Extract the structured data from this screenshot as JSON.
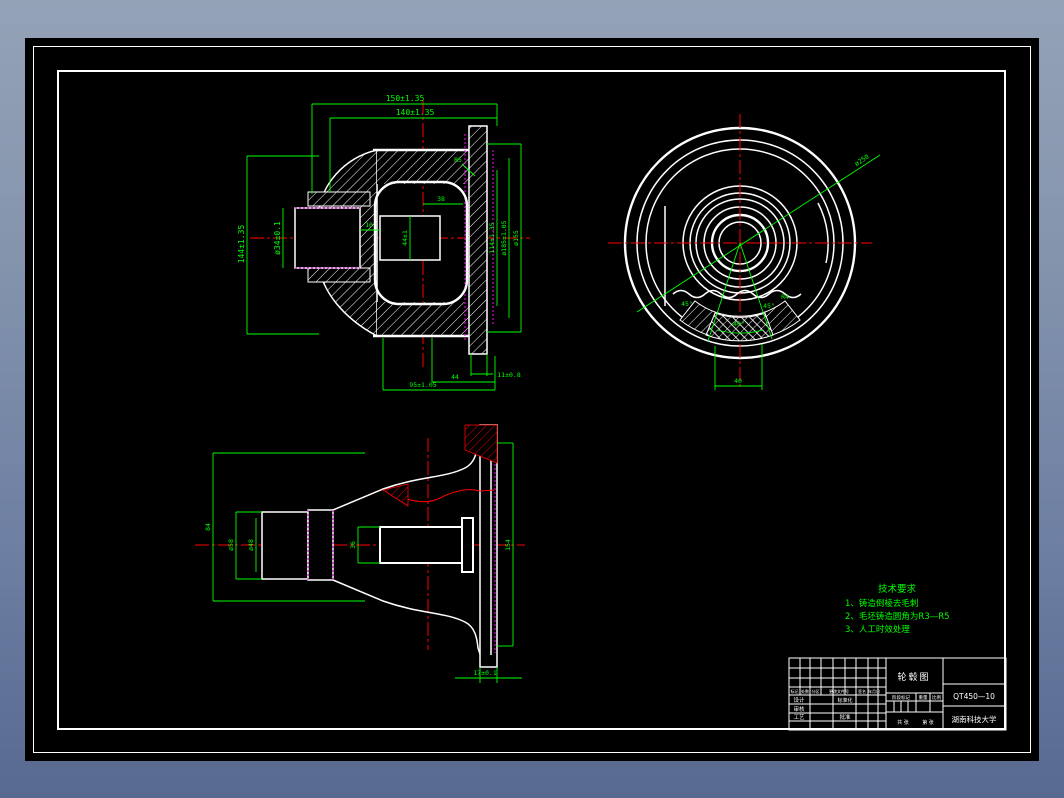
{
  "colors": {
    "desktop_top": "#94a2b8",
    "desktop_bottom": "#57698f",
    "canvas": "#000000",
    "frame": "#ffffff",
    "geometry": "#ffffff",
    "dimension": "#00ff00",
    "centerline": "#ff0000",
    "phantom": "#ff00ff"
  },
  "section_view": {
    "dims": {
      "width_outer": "150±1.35",
      "width_inner": "140±1.35",
      "height_left": "144±1.35",
      "shaft_dia": "ø34±0.1",
      "step": "10",
      "cavity": "38",
      "bore": "44±1",
      "flange_h": "114±1.35",
      "flange_dia": "ø185±1.05",
      "pitch_dia": "ø155",
      "fillet": "R5",
      "rim": "11±0.8",
      "bottom_inner": "44",
      "bottom_outer": "95±1.05"
    }
  },
  "front_view": {
    "dims": {
      "leader_dia": "ø250",
      "slot_width": "40",
      "angle_left": "45°",
      "angle_center": "40°",
      "angle_right": "45°",
      "fillet": "R4"
    }
  },
  "side_view": {
    "dims": {
      "boss_len": "84",
      "dia_outer": "ø58",
      "dia_inner": "ø48",
      "slot": "36",
      "flange_h": "154",
      "flange_t": "17±0.1"
    }
  },
  "tech_requirements": {
    "title": "技术要求",
    "items": [
      "1、铸造倒棱去毛刺",
      "2、毛坯铸造圆角为R3—R5",
      "3、人工时效处理"
    ]
  },
  "title_block": {
    "drawing_name": "轮毂图",
    "material": "QT450—10",
    "organization": "湖南科技大学",
    "labels": {
      "mark": "标记",
      "count": "处数",
      "zone": "分区",
      "change_file": "更改文件号",
      "signature": "签名",
      "date": "年月日",
      "design": "设计",
      "standardization": "标准化",
      "review": "审核",
      "process": "工艺",
      "approve": "批准",
      "stage_mark": "阶段标记",
      "weight": "重量",
      "scale": "比例",
      "sheets": "共 张",
      "page": "第 张"
    }
  }
}
